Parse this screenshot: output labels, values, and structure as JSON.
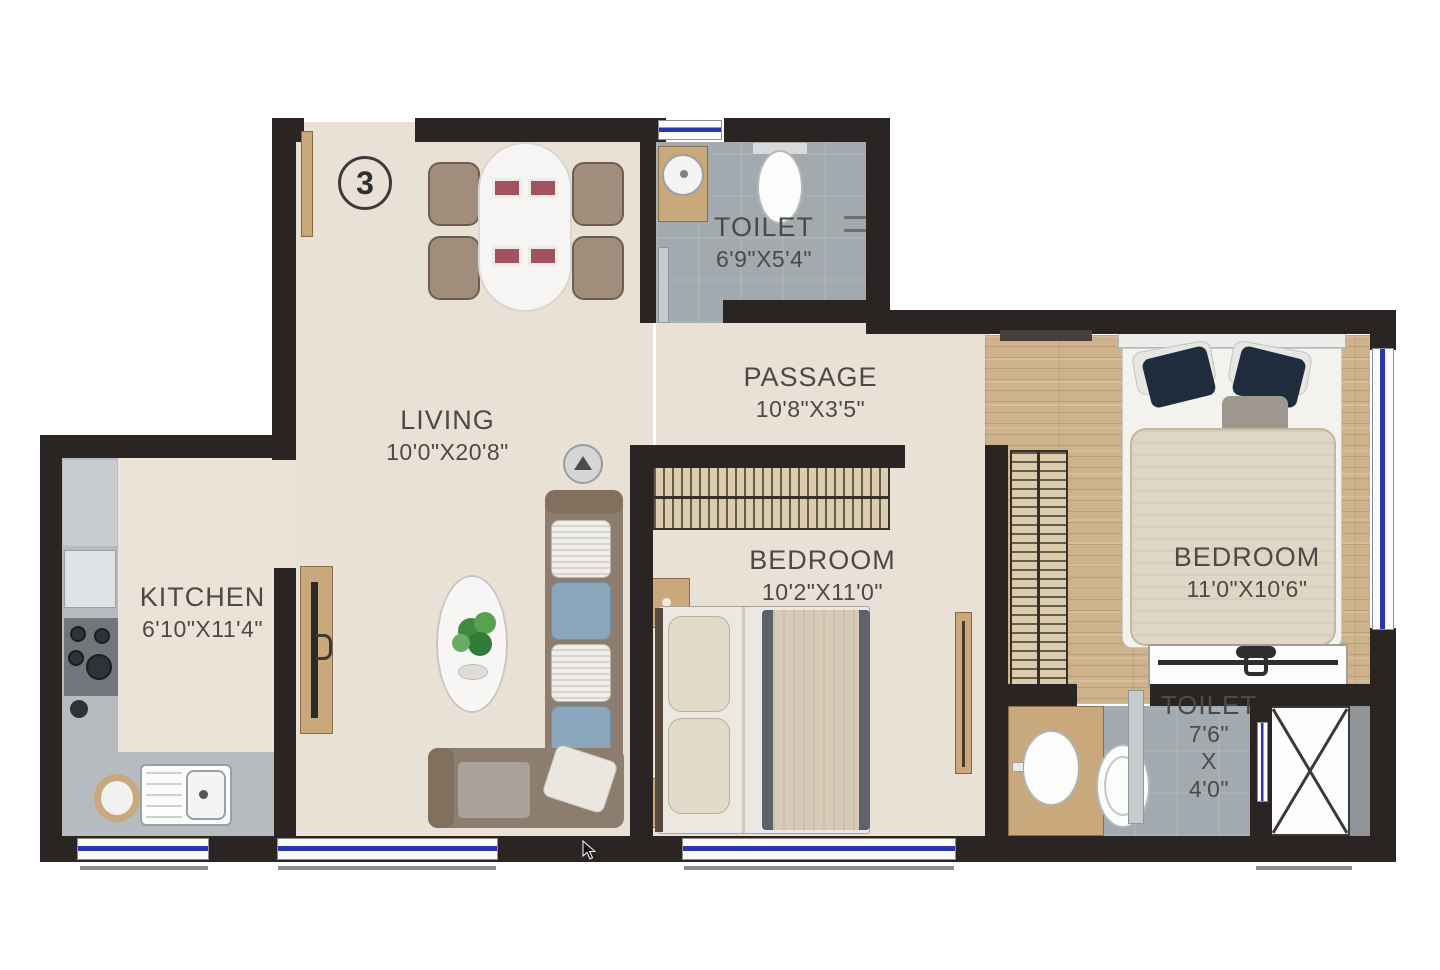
{
  "unit": {
    "number": "3"
  },
  "rooms": {
    "toilet_top": {
      "name": "TOILET",
      "dims": "6'9\"X5'4\""
    },
    "passage": {
      "name": "PASSAGE",
      "dims": "10'8\"X3'5\""
    },
    "living": {
      "name": "LIVING",
      "dims": "10'0\"X20'8\""
    },
    "kitchen": {
      "name": "KITCHEN",
      "dims": "6'10\"X11'4\""
    },
    "bedroom_middle": {
      "name": "BEDROOM",
      "dims": "10'2\"X11'0\""
    },
    "bedroom_right": {
      "name": "BEDROOM",
      "dims": "11'0\"X10'6\""
    },
    "toilet_bottom": {
      "name": "TOILET",
      "dim_width": "7'6\"",
      "dim_sep": "X",
      "dim_height": "4'0\""
    }
  },
  "colors": {
    "wall": "#2a2423",
    "floor": "#e9e1d6",
    "kitchen_floor": "#ece3d8",
    "tile": "#a3aaaf",
    "wood_floor": "#cdb28c",
    "window_blue": "#2836b0",
    "door_wood": "#c9a97c",
    "label": "#4b4a47",
    "sofa": "#8d7d6e",
    "wardrobe": "#dcccae"
  }
}
